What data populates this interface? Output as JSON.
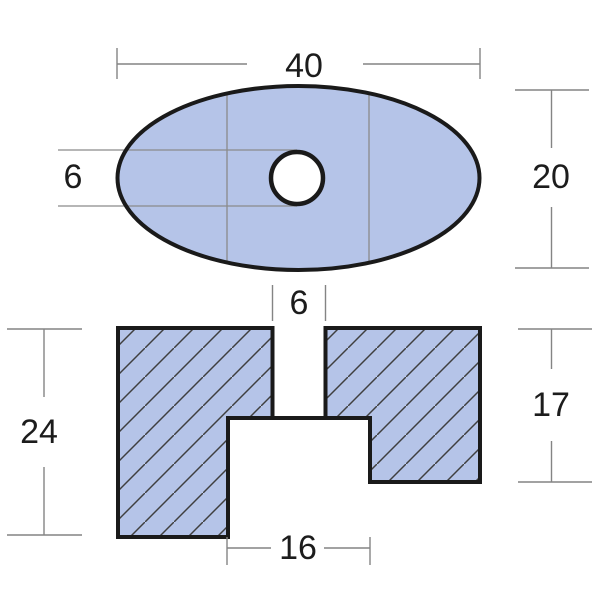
{
  "drawing": {
    "title": "part-dimension-drawing",
    "top_view": {
      "width_label": "40",
      "height_label": "20",
      "hole_diameter_label": "6"
    },
    "section_view": {
      "slot_width_label": "6",
      "overall_height_label": "24",
      "right_height_label": "17",
      "notch_width_label": "16"
    },
    "colors": {
      "background": "#ffffff",
      "part_fill": "#b5c4e8",
      "outline": "#1a1a1a",
      "hatch_line": "#3f3f3f",
      "dimension_line": "#848484",
      "text": "#1c1c1c"
    }
  }
}
